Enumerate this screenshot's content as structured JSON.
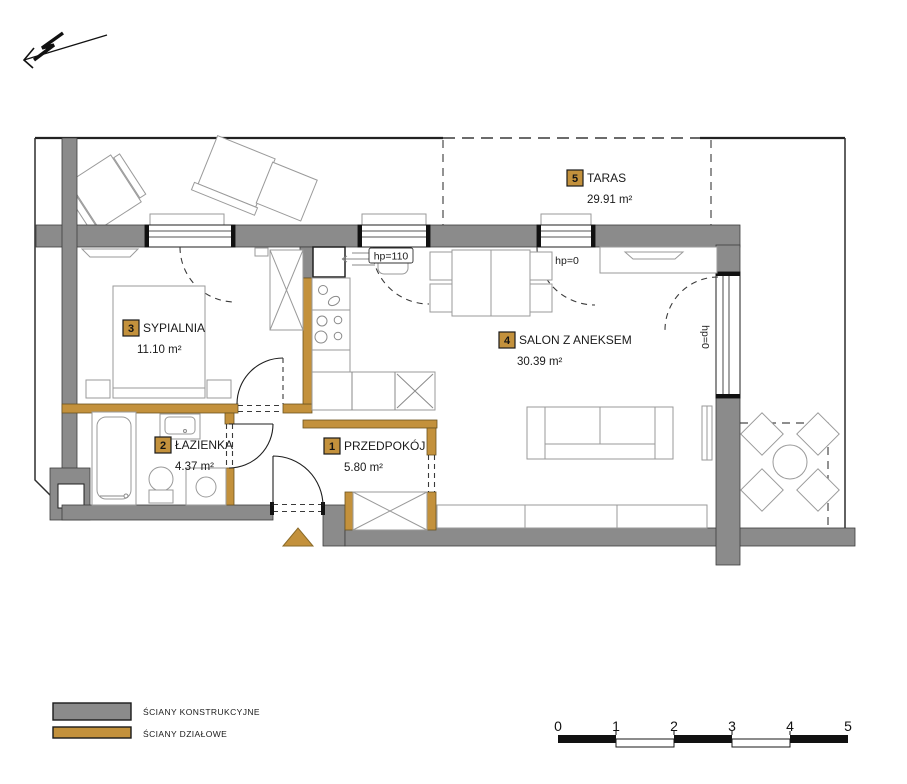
{
  "title": "Apartment floor plan",
  "rooms": [
    {
      "number": "1",
      "name": "PRZEDPOKÓJ",
      "area": "5.80 m²"
    },
    {
      "number": "2",
      "name": "ŁAZIENKA",
      "area": "4.37 m²"
    },
    {
      "number": "3",
      "name": "SYPIALNIA",
      "area": "11.10 m²"
    },
    {
      "number": "4",
      "name": "SALON Z ANEKSEM",
      "area": "30.39 m²"
    },
    {
      "number": "5",
      "name": "TARAS",
      "area": "29.91 m²"
    }
  ],
  "annotations": {
    "kitchen_window_sill": "hp=110",
    "balcony_door_sill": "hp=0",
    "side_door_sill": "hp=0"
  },
  "legend": {
    "items": [
      {
        "label": "ŚCIANY KONSTRUKCYJNE",
        "color": "#8b8b8b"
      },
      {
        "label": "ŚCIANY DZIAŁOWE",
        "color": "#c3913c"
      }
    ]
  },
  "scale_bar": {
    "ticks": [
      "0",
      "1",
      "2",
      "3",
      "4",
      "5"
    ]
  },
  "colors": {
    "structural_wall": "#8b8b8b",
    "partition_wall": "#c3913c",
    "background": "#ffffff",
    "line": "#1f1f1f"
  }
}
